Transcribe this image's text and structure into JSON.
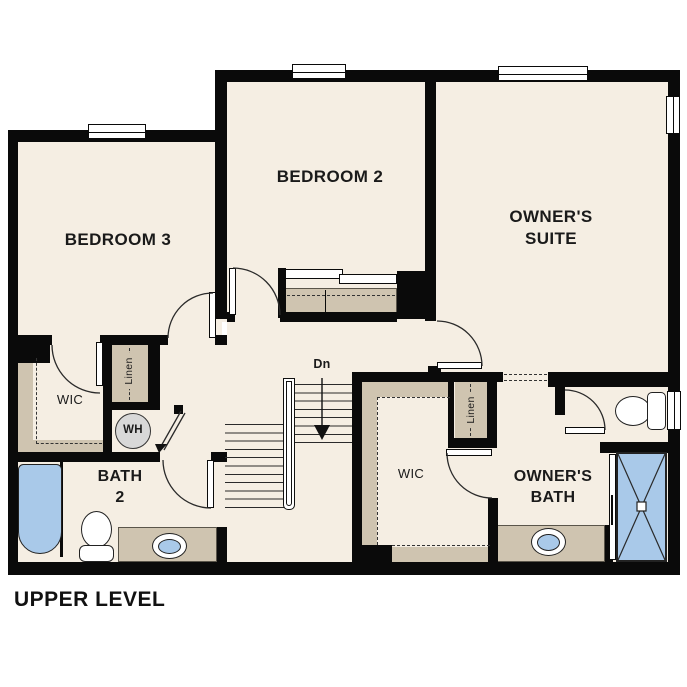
{
  "title": "UPPER LEVEL",
  "rooms": {
    "bedroom3": "BEDROOM 3",
    "bedroom2": "BEDROOM 2",
    "owners_suite": "OWNER'S\nSUITE",
    "owners_bath": "OWNER'S\nBATH",
    "bath2": "BATH\n2",
    "wic_left": "WIC",
    "wic_right": "WIC",
    "linen_left": "Linen",
    "linen_right": "Linen",
    "water_heater": "WH",
    "stairs_down": "Dn"
  },
  "colors": {
    "background": "#ffffff",
    "wall": "#0a0a0a",
    "floor": "#f5eee3",
    "shelving": "#cfc4b0",
    "fixture_blue": "#a9c9e9",
    "water_heater_gray": "#d8d8d8",
    "text": "#1a1a1a"
  }
}
